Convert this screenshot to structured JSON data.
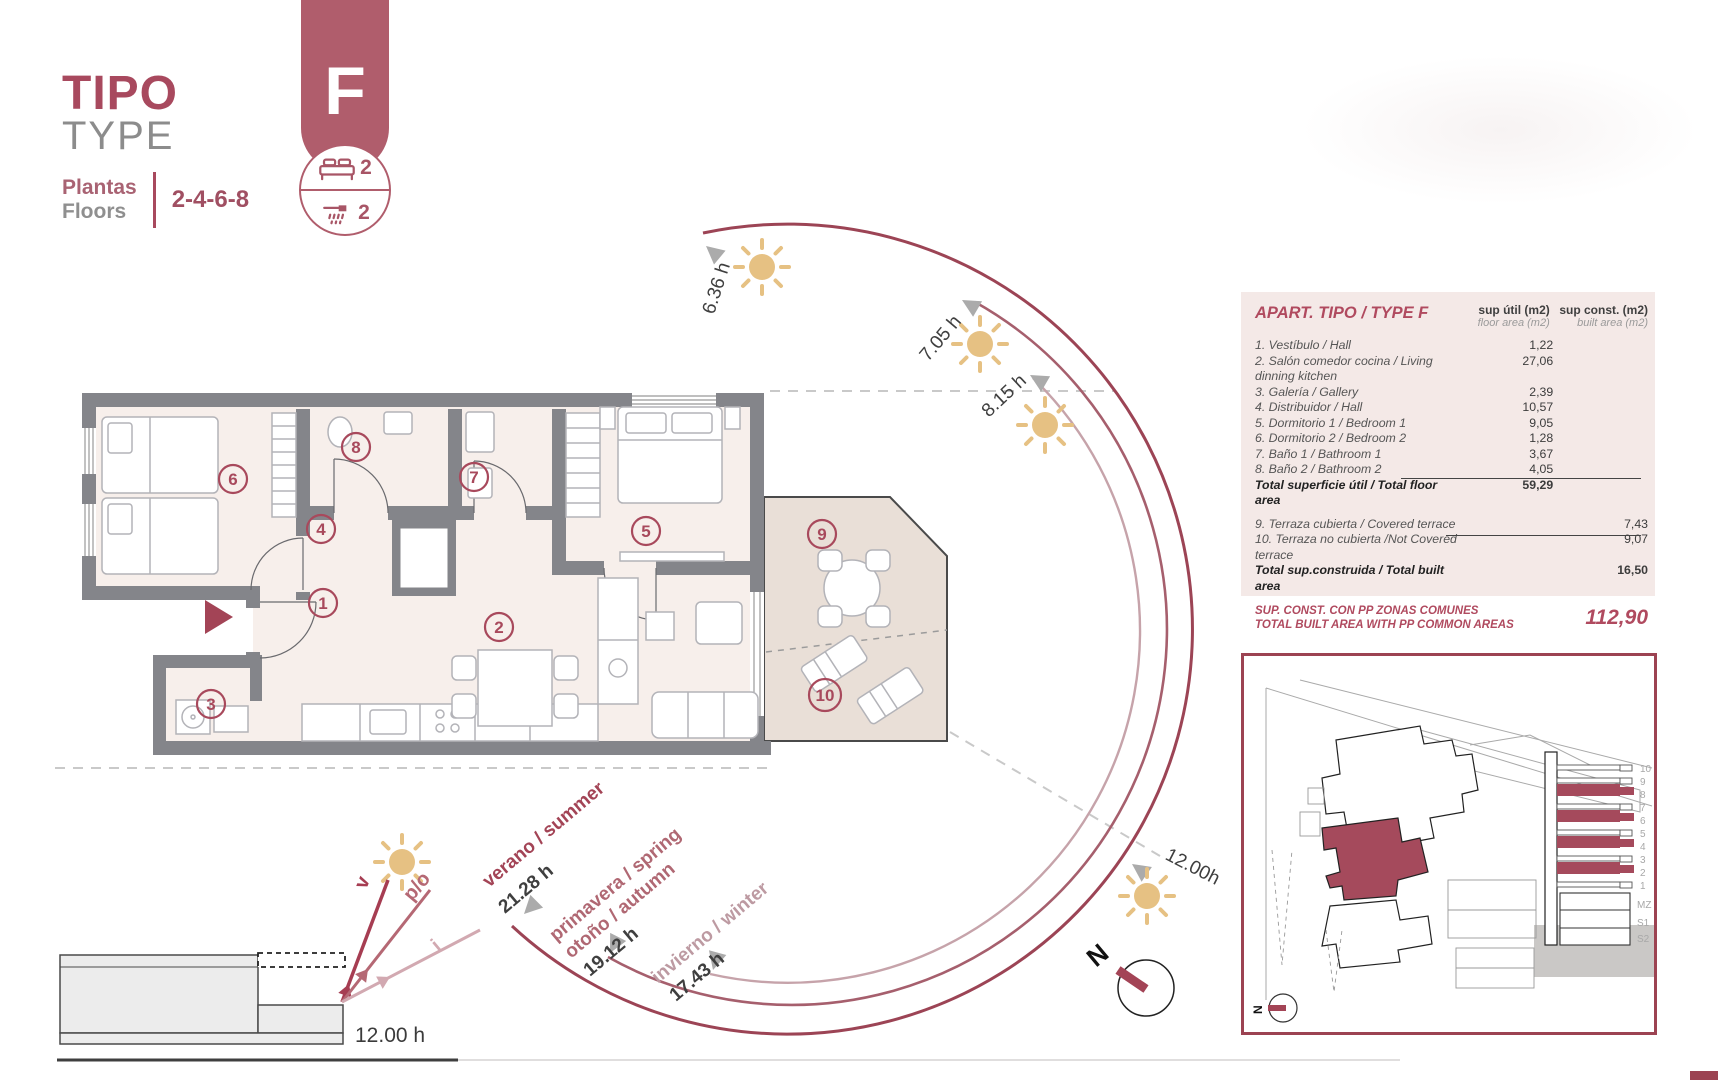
{
  "header": {
    "title_primary": "TIPO",
    "title_secondary": "TYPE",
    "floors_label_primary": "Plantas",
    "floors_label_secondary": "Floors",
    "floors_value": "2-4-6-8"
  },
  "badge": {
    "letter": "F",
    "bedrooms": "2",
    "bathrooms": "2"
  },
  "area_table": {
    "title": "APART. TIPO / TYPE F",
    "col_floor_line1": "sup útil (m2)",
    "col_floor_line2": "floor area (m2)",
    "col_built_line1": "sup const. (m2)",
    "col_built_line2": "built area (m2)",
    "rows": [
      {
        "label": "1. Vestíbulo / Hall",
        "floor": "1,22",
        "built": ""
      },
      {
        "label": "2. Salón comedor cocina / Living dinning kitchen",
        "floor": "27,06",
        "built": ""
      },
      {
        "label": "3. Galería / Gallery",
        "floor": "2,39",
        "built": ""
      },
      {
        "label": "4. Distribuidor / Hall",
        "floor": "10,57",
        "built": ""
      },
      {
        "label": "5. Dormitorio 1 / Bedroom 1",
        "floor": "9,05",
        "built": ""
      },
      {
        "label": "6. Dormitorio 2 / Bedroom 2",
        "floor": "1,28",
        "built": ""
      },
      {
        "label": "7. Baño 1 / Bathroom 1",
        "floor": "3,67",
        "built": ""
      },
      {
        "label": "8. Baño 2 / Bathroom 2",
        "floor": "4,05",
        "built": ""
      }
    ],
    "total_floor": {
      "label": "Total superficie útil / Total floor area",
      "value": "59,29"
    },
    "terrace_rows": [
      {
        "label": "9. Terraza cubierta / Covered terrace",
        "built": "7,43"
      },
      {
        "label": "10. Terraza no cubierta /Not Covered terrace",
        "built": "9,07"
      }
    ],
    "total_built": {
      "label": "Total sup.construida / Total built area",
      "value": "16,50"
    },
    "grand_total": {
      "label_line1": "SUP. CONST. CON PP ZONAS COMUNES",
      "label_line2": "TOTAL BUILT AREA WITH PP COMMON AREAS",
      "value": "112,90"
    }
  },
  "plan": {
    "rooms": [
      "1",
      "2",
      "3",
      "4",
      "5",
      "6",
      "7",
      "8",
      "9",
      "10"
    ]
  },
  "sun_diagram": {
    "hour_labels": [
      "6.36 h",
      "7.05 h",
      "8.15 h",
      "12.00h"
    ],
    "seasons": [
      {
        "name": "verano / summer",
        "hours": "21.28 h"
      },
      {
        "name_line1": "primavera / spring",
        "name_line2": "otoño / autumn",
        "hours": "19.12 h"
      },
      {
        "name": "invierno / winter",
        "hours": "17.43 h"
      }
    ],
    "ray_labels": [
      "v",
      "p/o",
      "i"
    ],
    "section_hour": "12.00 h",
    "north": "N"
  },
  "site_plan": {
    "floor_labels": [
      "10",
      "9",
      "8",
      "7",
      "6",
      "5",
      "4",
      "3",
      "2",
      "1",
      "MZ",
      "S1",
      "S2"
    ],
    "north": "N"
  },
  "colors": {
    "accent": "#a8495c",
    "badge": "#b05d6c",
    "table_bg": "#f4e9e7",
    "wall": "#84858a",
    "floor": "#f7efeb",
    "terrace": "#e9dfd7",
    "sun": "#e6c183",
    "arc_dark": "#9c4455",
    "arc_mid": "#a65f6d",
    "arc_light": "#c6a3aa"
  }
}
